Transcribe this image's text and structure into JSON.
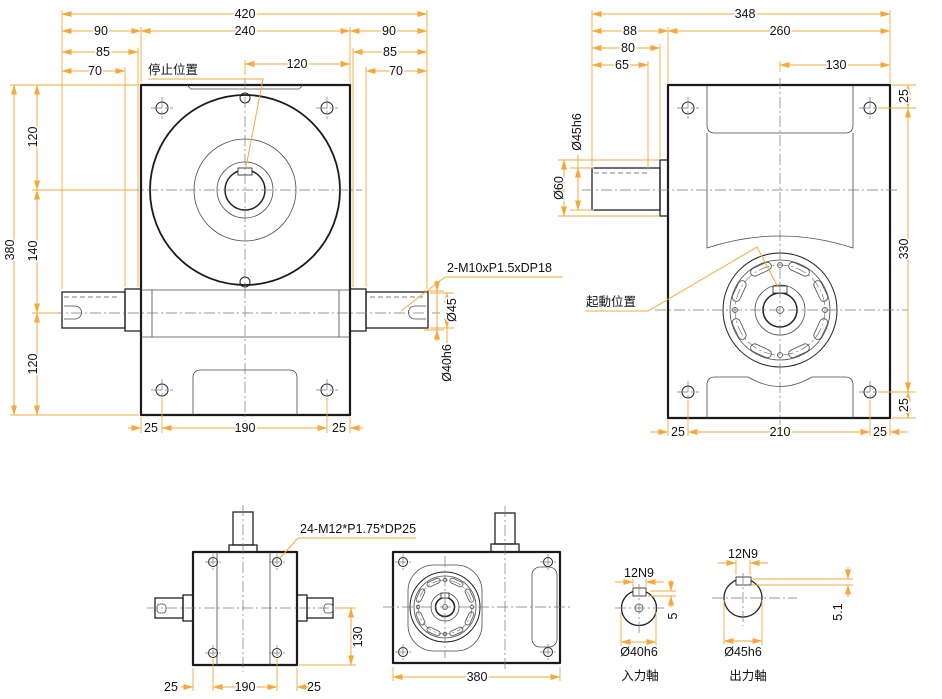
{
  "front": {
    "d420": "420",
    "d90l": "90",
    "d240": "240",
    "d90r": "90",
    "d85l": "85",
    "d85r": "85",
    "d70l": "70",
    "d70r": "70",
    "d120top": "120",
    "d380": "380",
    "d120a": "120",
    "d140": "140",
    "d120b": "120",
    "d25l": "25",
    "d190": "190",
    "d25r": "25",
    "note_tap": "2-M10xP1.5xDP18",
    "d45": "Ø45",
    "d40h6": "Ø40h6",
    "label_stop": "停止位置"
  },
  "side": {
    "d348": "348",
    "d88": "88",
    "d260": "260",
    "d80": "80",
    "d65": "65",
    "d130": "130",
    "d25t": "25",
    "d330": "330",
    "d25b": "25",
    "d25bl": "25",
    "d210": "210",
    "d25br": "25",
    "d45h6": "Ø45h6",
    "d60": "Ø60",
    "label_start": "起動位置"
  },
  "bottom": {
    "note_tap": "24-M12*P1.75*DP25",
    "d130": "130",
    "d25l": "25",
    "d190": "190",
    "d25r": "25"
  },
  "top": {
    "d380": "380"
  },
  "input_shaft": {
    "key": "12N9",
    "depth": "5",
    "dia": "Ø40h6",
    "label": "入力軸"
  },
  "output_shaft": {
    "key": "12N9",
    "depth": "5.1",
    "dia": "Ø45h6",
    "label": "出力軸"
  },
  "colors": {
    "dimension_line": "#F5A83C",
    "drawing_line": "#1A1A1A",
    "centerline": "#777777",
    "background": "#FFFFFF"
  }
}
